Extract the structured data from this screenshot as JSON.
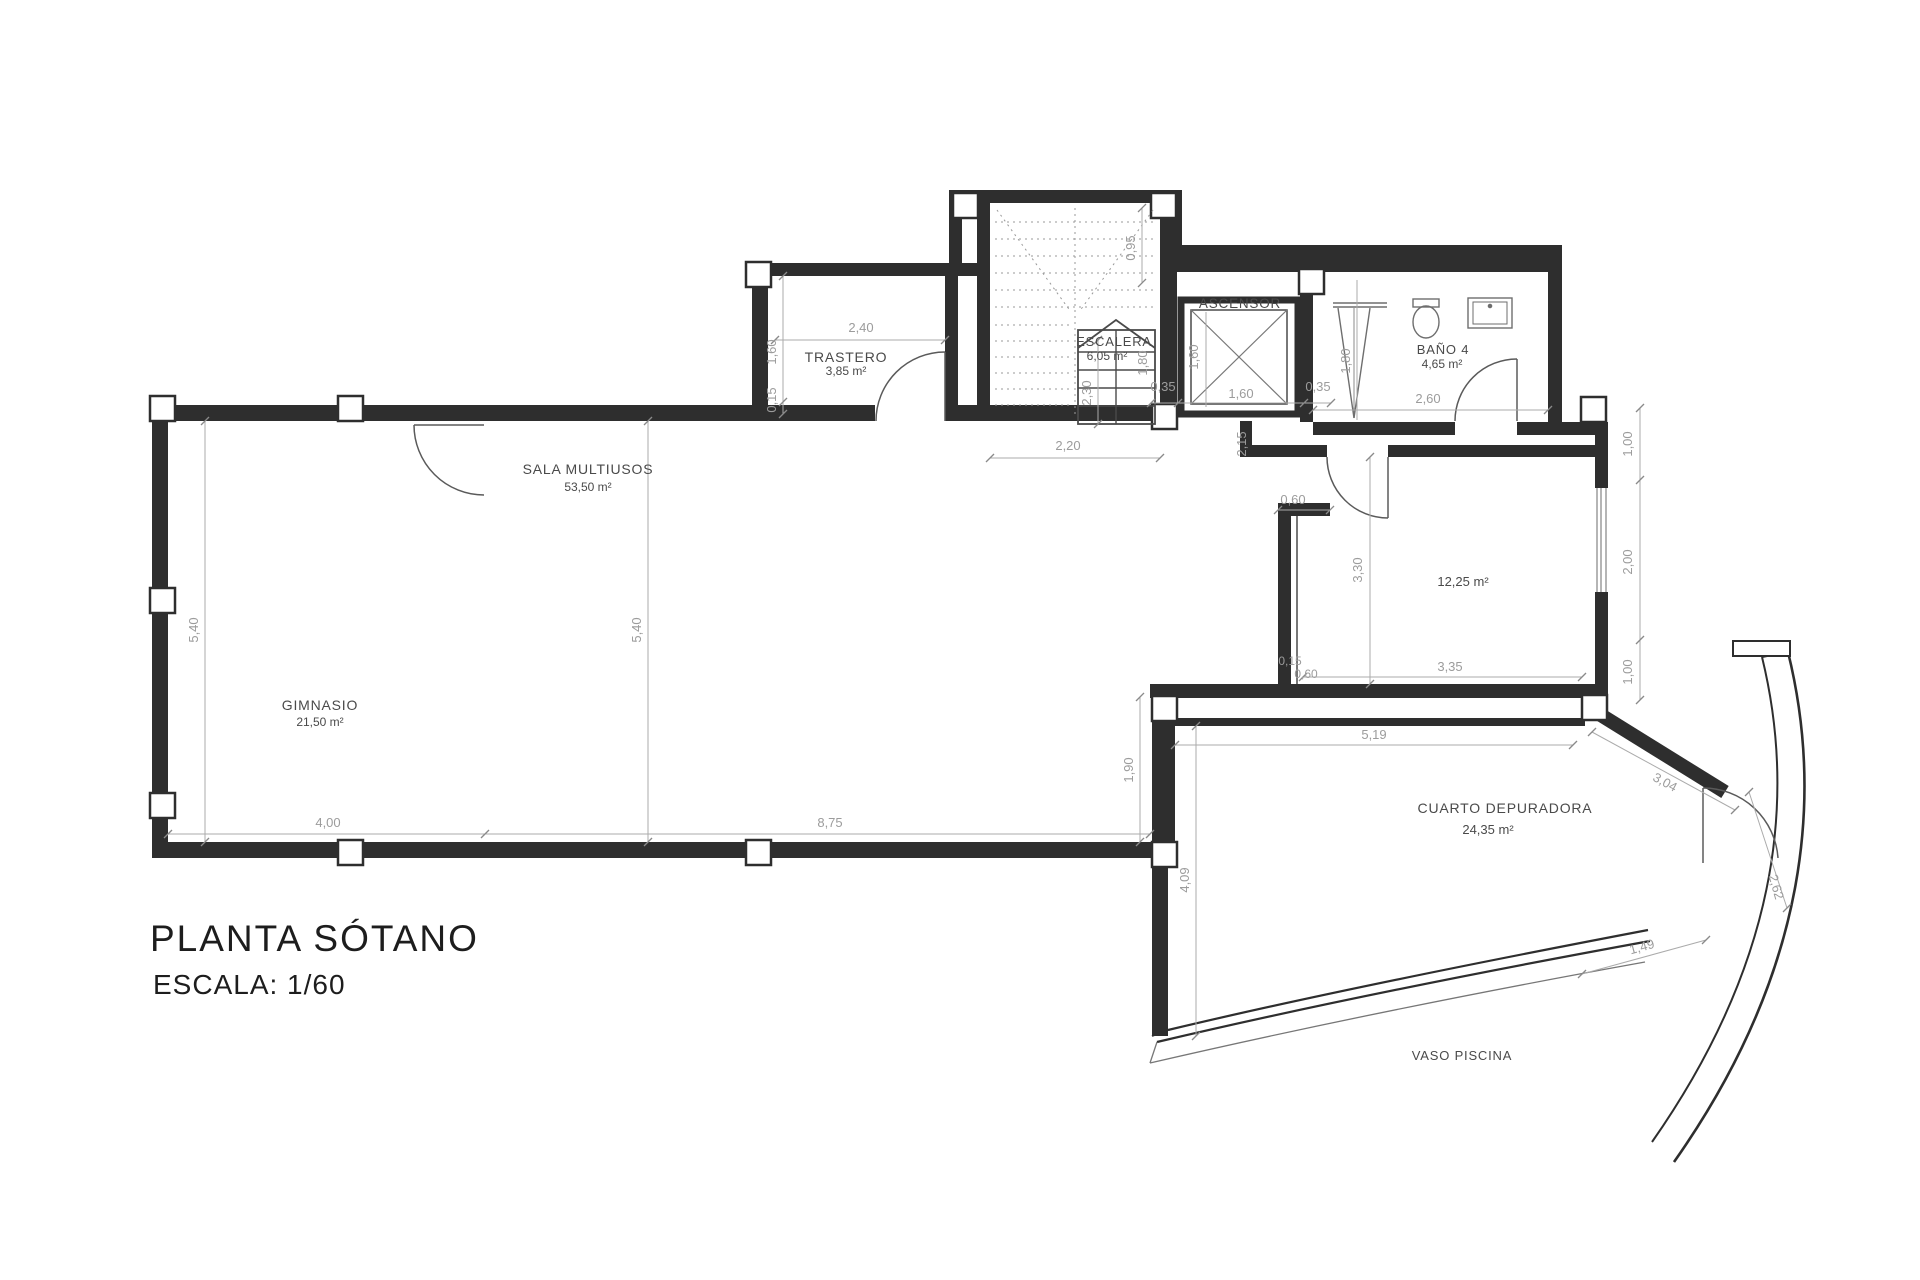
{
  "title": {
    "line1": "PLANTA SÓTANO",
    "line2": "ESCALA: 1/60"
  },
  "rooms": {
    "gimnasio": {
      "name": "GIMNASIO",
      "area": "21,50 m²"
    },
    "sala_multiusos": {
      "name": "SALA MULTIUSOS",
      "area": "53,50 m²"
    },
    "trastero": {
      "name": "TRASTERO",
      "area": "3,85 m²"
    },
    "escalera": {
      "name": "ESCALERA",
      "area": "6,05 m²"
    },
    "ascensor": {
      "name": "ASCENSOR"
    },
    "bano4": {
      "name": "BAÑO 4",
      "area": "4,65 m²"
    },
    "sala_derecha": {
      "area": "12,25 m²"
    },
    "cuarto_depuradora": {
      "name": "CUARTO DEPURADORA",
      "area": "24,35 m²"
    },
    "vaso_piscina": {
      "name": "VASO PISCINA"
    }
  },
  "dimensions": {
    "gym_width": "4,00",
    "sala_width": "8,75",
    "gym_height": "5,40",
    "sala_height": "5,40",
    "step_height": "1,90",
    "trastero_width": "2,40",
    "trastero_depth": "1,60",
    "trastero_wall": "0,15",
    "stair_upper": "0,95",
    "stair_width": "2,20",
    "stair_depth": "2,30",
    "stair_side": "1,80",
    "asc_left": "0,35",
    "asc_width": "1,60",
    "asc_height": "1,60",
    "asc_right": "0,35",
    "hall_opening": "2,15",
    "shower_len": "1,80",
    "bano_width": "2,60",
    "nook_top": "0,60",
    "room12_height": "3,30",
    "room12_wall": "0,15",
    "room12_nook": "0,60",
    "room12_width": "3,35",
    "right_upper": "1,00",
    "right_mid": "2,00",
    "right_lower": "1,00",
    "dep_width": "5,19",
    "dep_height": "4,09",
    "dep_diag": "3,04",
    "pool_edge": "2,62",
    "pool_inner": "1,49"
  },
  "colors": {
    "wall": "#2e2e2e",
    "partition": "#4a4a4a",
    "fixture": "#6e6e6e",
    "dimension": "#9c9c9c",
    "room_label": "#4a4a4a",
    "title": "#1d1d1d",
    "background": "#ffffff"
  }
}
